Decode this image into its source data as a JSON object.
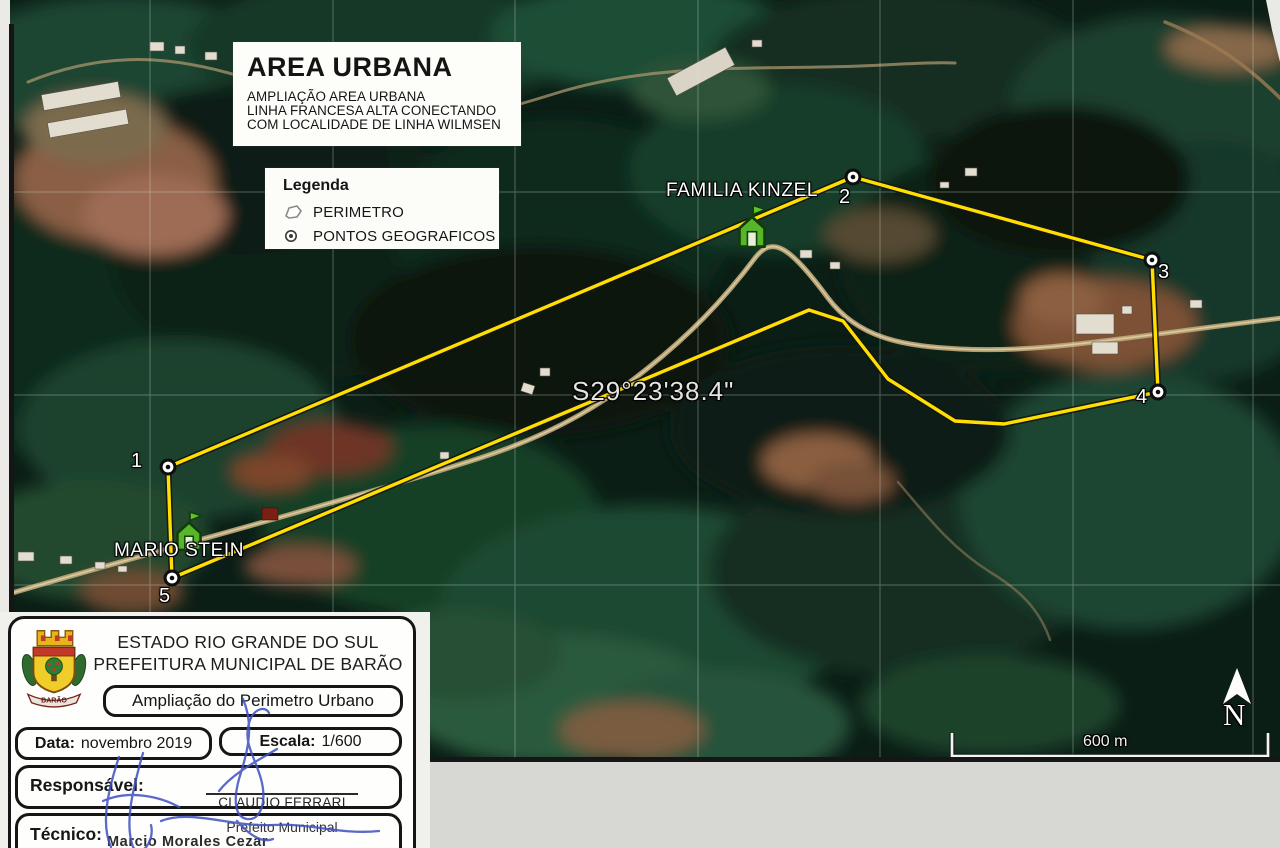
{
  "colors": {
    "perimeter_yellow": "#ffdf00",
    "line_casing_black": "#141414",
    "signature_blue": "#3f51c1",
    "paper_gray": "#d7d7d3",
    "placemark_green": "#57b52a"
  },
  "map": {
    "header_box": {
      "title": "AREA URBANA",
      "subtitle_lines": [
        "AMPLIAÇÃO AREA URBANA",
        "LINHA FRANCESA ALTA CONECTANDO",
        "COM LOCALIDADE DE LINHA WILMSEN"
      ]
    },
    "legend": {
      "title": "Legenda",
      "items": [
        {
          "icon": "perimeter-polygon-icon",
          "label": "PERIMETRO"
        },
        {
          "icon": "geographic-point-icon",
          "label": "PONTOS GEOGRAFICOS"
        }
      ]
    },
    "place_labels": {
      "familia_kinzel": "FAMILIA KINZEL",
      "mario_stein": "MARIO STEIN",
      "coordinate": "S29°23'38.4\""
    },
    "points": [
      {
        "label": "1"
      },
      {
        "label": "2"
      },
      {
        "label": "3"
      },
      {
        "label": "4"
      },
      {
        "label": "5"
      }
    ],
    "scale_bar_label": "600 m",
    "north_label": "N"
  },
  "title_block": {
    "org_line1": "ESTADO RIO GRANDE DO SUL",
    "org_line2": "PREFEITURA MUNICIPAL DE BARÃO",
    "crest_text": "BARÃO",
    "subject": "Ampliação do Perimetro Urbano",
    "date_label": "Data:",
    "date_value": "novembro 2019",
    "scale_label": "Escala:",
    "scale_value": "1/600",
    "responsible_label": "Responsável:",
    "responsible_name": "CLAUDIO FERRARI",
    "responsible_title": "Prefeito Municipal",
    "technician_label": "Técnico:",
    "technician_name": "Marcio Morales Cezar"
  }
}
